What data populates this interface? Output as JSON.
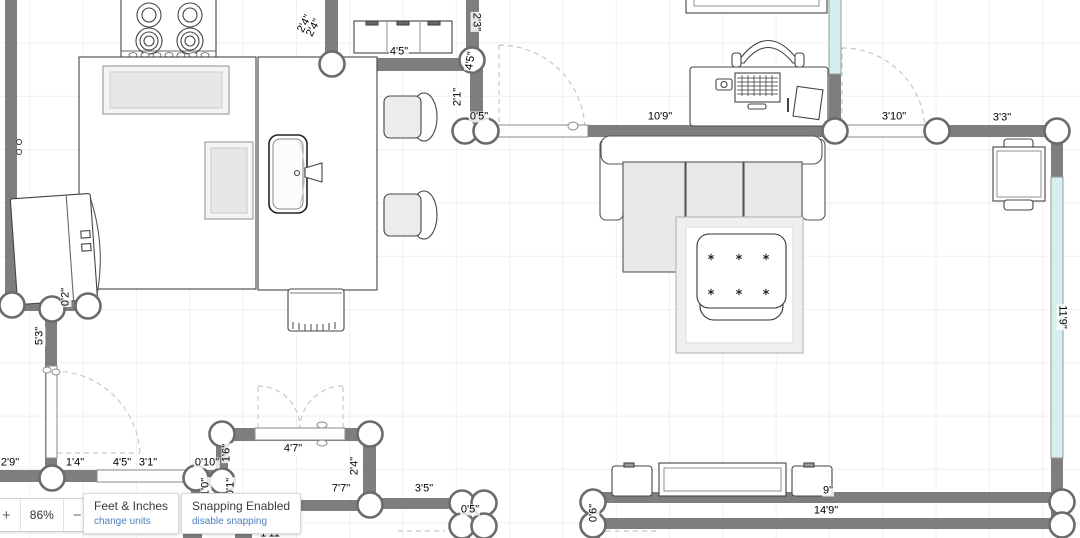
{
  "ui": {
    "zoom": {
      "plus_label": "+",
      "value": "86%",
      "minus_label": "−"
    },
    "units_card": {
      "title": "Feet & Inches",
      "action": "change units"
    },
    "snapping_card": {
      "title": "Snapping Enabled",
      "action": "disable snapping"
    }
  },
  "colors": {
    "wall": "#7e7e7e",
    "window_fill": "#d5efee",
    "link": "#4d7fc0",
    "grid": "#f0f0f0"
  },
  "plan": {
    "dimension_labels": [
      {
        "text": "2'4\"",
        "x": 305,
        "y": 24,
        "rot": -62
      },
      {
        "text": "2'4\"",
        "x": 314,
        "y": 28,
        "rot": -62
      },
      {
        "text": "4'5\"",
        "x": 399,
        "y": 52,
        "rot": 0
      },
      {
        "text": "2'3\"",
        "x": 476,
        "y": 22,
        "rot": 90
      },
      {
        "text": "4'5\"",
        "x": 471,
        "y": 61,
        "rot": -80
      },
      {
        "text": "2'1\"",
        "x": 458,
        "y": 97,
        "rot": -90
      },
      {
        "text": "0'5\"",
        "x": 479,
        "y": 117,
        "rot": 0
      },
      {
        "text": "10'9\"",
        "x": 660,
        "y": 117,
        "rot": 0
      },
      {
        "text": "3'10\"",
        "x": 894,
        "y": 117,
        "rot": 0
      },
      {
        "text": "3'3\"",
        "x": 1002,
        "y": 118,
        "rot": 0
      },
      {
        "text": "11'9\"",
        "x": 1062,
        "y": 317,
        "rot": 90
      },
      {
        "text": "0'2\"",
        "x": 66,
        "y": 297,
        "rot": -90
      },
      {
        "text": "5'3\"",
        "x": 40,
        "y": 336,
        "rot": -90
      },
      {
        "text": "2'9\"",
        "x": 10,
        "y": 463,
        "rot": 0
      },
      {
        "text": "1'4\"",
        "x": 75,
        "y": 463,
        "rot": 0
      },
      {
        "text": "4'5\"",
        "x": 122,
        "y": 463,
        "rot": 0
      },
      {
        "text": "3'1\"",
        "x": 148,
        "y": 463,
        "rot": 0
      },
      {
        "text": "0'10\"",
        "x": 207,
        "y": 463,
        "rot": 0
      },
      {
        "text": "1'0\"",
        "x": 206,
        "y": 487,
        "rot": -90
      },
      {
        "text": "0'1\"",
        "x": 231,
        "y": 487,
        "rot": -90
      },
      {
        "text": "1'6\"",
        "x": 227,
        "y": 453,
        "rot": -90
      },
      {
        "text": "4'7\"",
        "x": 293,
        "y": 449,
        "rot": 0
      },
      {
        "text": "2'4\"",
        "x": 355,
        "y": 466,
        "rot": -90
      },
      {
        "text": "7'7\"",
        "x": 341,
        "y": 489,
        "rot": 0
      },
      {
        "text": "3'5\"",
        "x": 424,
        "y": 489,
        "rot": 0
      },
      {
        "text": "0'5\"",
        "x": 470,
        "y": 510,
        "rot": 0
      },
      {
        "text": "0'6\"",
        "x": 594,
        "y": 513,
        "rot": -90
      },
      {
        "text": "9\"",
        "x": 828,
        "y": 491,
        "rot": 0
      },
      {
        "text": "14'9\"",
        "x": 826,
        "y": 511,
        "rot": 0
      },
      {
        "text": "1'11\"",
        "x": 272,
        "y": 534,
        "rot": 0
      }
    ]
  }
}
